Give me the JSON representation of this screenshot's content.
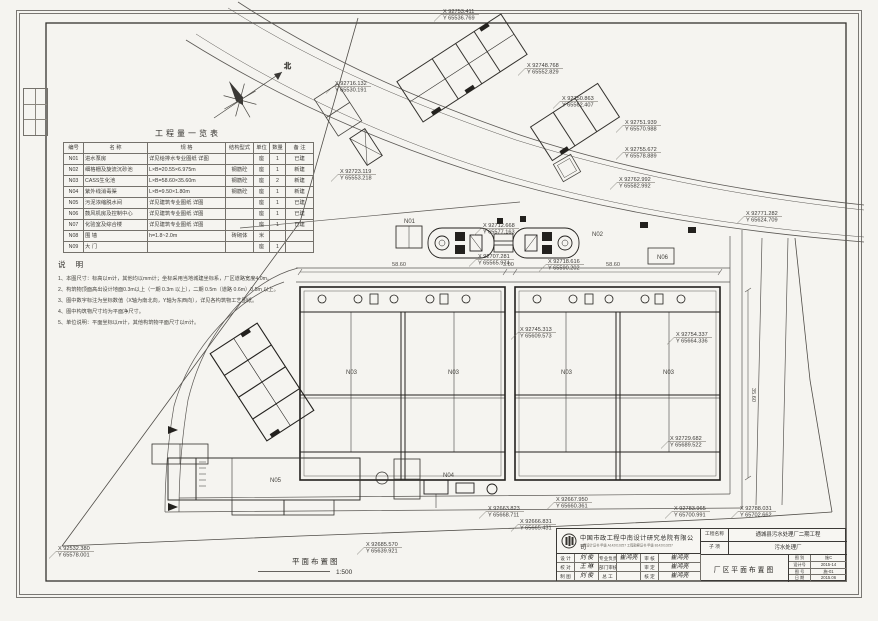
{
  "compass": {
    "north_label": "北"
  },
  "quantity_table": {
    "title": "工程量一览表",
    "headers": [
      "编号",
      "名    称",
      "规    格",
      "结构型式",
      "单位",
      "数量",
      "备  注"
    ],
    "rows": [
      [
        "N01",
        "进水泵房",
        "详见给排水专业图纸 详图",
        "",
        "座",
        "1",
        "已建"
      ],
      [
        "N02",
        "细格栅及旋流沉砂池",
        "L×B=20.55×6.975m",
        "钢筋砼",
        "座",
        "1",
        "新建"
      ],
      [
        "N03",
        "CASS生化池",
        "L×B=58.60×35.60m",
        "钢筋砼",
        "座",
        "2",
        "新建"
      ],
      [
        "N04",
        "紫外线消毒渠",
        "L×B=9.50×1.80m",
        "钢筋砼",
        "座",
        "1",
        "新建"
      ],
      [
        "N05",
        "污泥浓缩脱水间",
        "详见建筑专业图纸 详图",
        "",
        "座",
        "1",
        "已建"
      ],
      [
        "N06",
        "鼓风机房及控制中心",
        "详见建筑专业图纸 详图",
        "",
        "座",
        "1",
        "已建"
      ],
      [
        "N07",
        "化验室及综合楼",
        "详见建筑专业图纸 详图",
        "",
        "座",
        "1",
        "已建"
      ],
      [
        "N08",
        "围  墙",
        "h=1.8~2.0m",
        "砖砌体",
        "米",
        "",
        ""
      ],
      [
        "N09",
        "大  门",
        "",
        "",
        "座",
        "1",
        ""
      ]
    ]
  },
  "notes": {
    "title": "说  明",
    "items": [
      "1、本图尺寸：标高以m计，其他均以mm计；坐标采用当地城建坐标系，厂区道路宽度4.0m。",
      "2、构筑物顶面高出设计地面0.3m以上（一期 0.3m 以上），二期 0.5m（道路 0.6m）0.5m 以上。",
      "3、图中数字标注为坐标数值（X轴为南北向，Y轴为东西向），详见各构筑物工艺图纸。",
      "4、图中构筑物尺寸均为平面净尺寸。",
      "5、单位说明：平面坐标以m计，其他构筑物平面尺寸以m计。"
    ]
  },
  "plan": {
    "drawing_label": "平面布置图",
    "scale": "1:500",
    "coords": [
      {
        "x_label": "X 92753.411",
        "y_label": "Y 65536.769",
        "x": 443,
        "y": 8
      },
      {
        "x_label": "X 92748.768",
        "y_label": "Y 65552.829",
        "x": 527,
        "y": 62
      },
      {
        "x_label": "X 92750.863",
        "y_label": "Y 65562.407",
        "x": 562,
        "y": 95
      },
      {
        "x_label": "X 92716.132",
        "y_label": "Y 65530.191",
        "x": 335,
        "y": 80
      },
      {
        "x_label": "X 92723.119",
        "y_label": "Y 65553.218",
        "x": 340,
        "y": 168
      },
      {
        "x_label": "X 92751.939",
        "y_label": "Y 65570.988",
        "x": 625,
        "y": 119
      },
      {
        "x_label": "X 92755.672",
        "y_label": "Y 65578.889",
        "x": 625,
        "y": 146
      },
      {
        "x_label": "X 92762.992",
        "y_label": "Y 65582.992",
        "x": 619,
        "y": 176
      },
      {
        "x_label": "X 92771.282",
        "y_label": "Y 65624.709",
        "x": 746,
        "y": 210
      },
      {
        "x_label": "X 92712.668",
        "y_label": "Y 65577.163",
        "x": 483,
        "y": 222
      },
      {
        "x_label": "X 92707.281",
        "y_label": "Y 65565.974",
        "x": 478,
        "y": 253
      },
      {
        "x_label": "X 92718.616",
        "y_label": "Y 65590.202",
        "x": 548,
        "y": 258
      },
      {
        "x_label": "X 92745.313",
        "y_label": "Y 65609.573",
        "x": 520,
        "y": 326
      },
      {
        "x_label": "X 92754.337",
        "y_label": "Y 65664.336",
        "x": 676,
        "y": 331
      },
      {
        "x_label": "X 92729.682",
        "y_label": "Y 65689.522",
        "x": 670,
        "y": 435
      },
      {
        "x_label": "X 92663.823",
        "y_label": "Y 65668.711",
        "x": 488,
        "y": 505
      },
      {
        "x_label": "X 92667.950",
        "y_label": "Y 65660.361",
        "x": 556,
        "y": 496
      },
      {
        "x_label": "X 92666.831",
        "y_label": "Y 65665.431",
        "x": 520,
        "y": 518
      },
      {
        "x_label": "X 92783.965",
        "y_label": "Y 65700.991",
        "x": 674,
        "y": 505
      },
      {
        "x_label": "X 92788.031",
        "y_label": "Y 65702.662",
        "x": 740,
        "y": 505
      },
      {
        "x_label": "X 92532.380",
        "y_label": "Y 65578.001",
        "x": 58,
        "y": 545
      },
      {
        "x_label": "X 92685.570",
        "y_label": "Y 65639.921",
        "x": 366,
        "y": 541
      }
    ],
    "structure_labels": [
      {
        "text": "N01",
        "x": 404,
        "y": 223
      },
      {
        "text": "N02",
        "x": 592,
        "y": 236
      },
      {
        "text": "N03",
        "x": 346,
        "y": 374
      },
      {
        "text": "N03",
        "x": 448,
        "y": 374
      },
      {
        "text": "N03",
        "x": 561,
        "y": 374
      },
      {
        "text": "N03",
        "x": 663,
        "y": 374
      },
      {
        "text": "N04",
        "x": 443,
        "y": 477
      },
      {
        "text": "N05",
        "x": 270,
        "y": 482
      },
      {
        "text": "N06",
        "x": 657,
        "y": 259
      }
    ],
    "dim_labels": [
      {
        "text": "58.60",
        "x": 392,
        "y": 266
      },
      {
        "text": "3.00",
        "x": 503,
        "y": 266
      },
      {
        "text": "58.60",
        "x": 606,
        "y": 266
      },
      {
        "text": "35.60",
        "x": 752,
        "y": 388,
        "rot": 90
      }
    ]
  },
  "title_block": {
    "company": "中国市政工程中南设计研究总院有限公司",
    "cert_line": "工程设计证书 甲级 A142010257   工程勘察证书 甲级 B142010257",
    "sig_grid": [
      [
        "设 计",
        "刘 俊",
        "专业负责",
        "崔鸿亮",
        "审 核",
        "崔鸿亮"
      ],
      [
        "校 对",
        "王 琳",
        "部门审核",
        "",
        "审 定",
        "崔鸿亮"
      ],
      [
        "制 图",
        "刘 俊",
        "总  工",
        "",
        "核 定",
        "崔鸿亮"
      ]
    ],
    "project_label": "工程名称",
    "project_value": "通城县污水处理厂二期工程",
    "sub_label": "子  项",
    "sub_value": "污水处理厂",
    "drawing_title": "厂区平面布置图",
    "info_rows": [
      [
        "图 别",
        "施C"
      ],
      [
        "设计号",
        "2015-14"
      ],
      [
        "图 号",
        "施-01"
      ],
      [
        "日 期",
        "2015.06"
      ]
    ]
  }
}
